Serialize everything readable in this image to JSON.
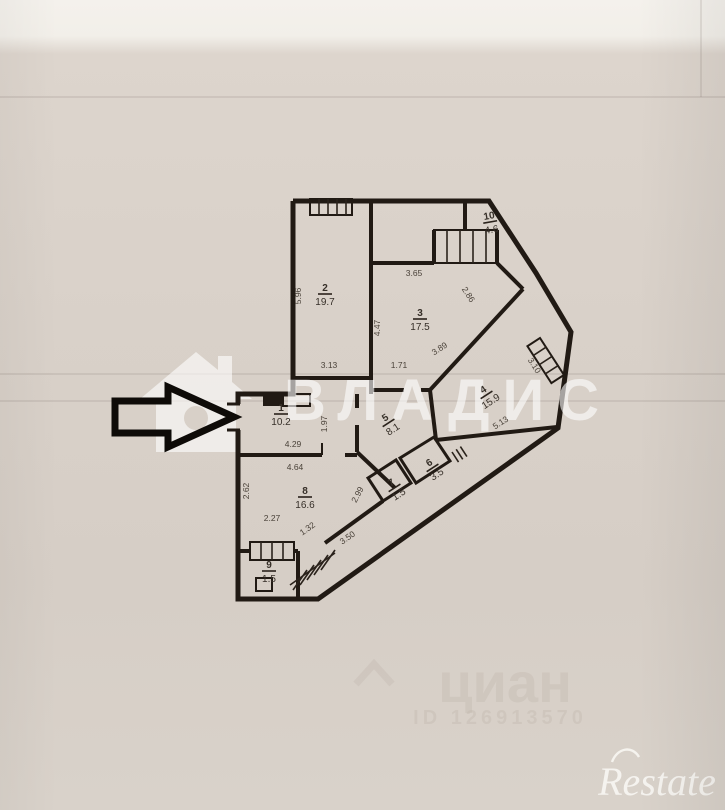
{
  "watermarks": {
    "vladis_text": "ВЛАДИС",
    "cian_text": "циан",
    "cian_id": "ID 126913570",
    "restate_text": "Restate"
  },
  "rooms": [
    {
      "number": "2",
      "area": "19.7"
    },
    {
      "number": "3",
      "area": "17.5"
    },
    {
      "number": "10",
      "area": "4.6"
    },
    {
      "number": "4",
      "area": "15.9"
    },
    {
      "number": "1",
      "area": "10.2"
    },
    {
      "number": "5",
      "area": "8.1"
    },
    {
      "number": "6",
      "area": "3.5"
    },
    {
      "number": "7",
      "area": "1.5"
    },
    {
      "number": "8",
      "area": "16.6"
    },
    {
      "number": "9",
      "area": "1.5"
    }
  ],
  "dimensions": [
    {
      "v": "5.96"
    },
    {
      "v": "3.13"
    },
    {
      "v": "4.47"
    },
    {
      "v": "3.65"
    },
    {
      "v": "2.86"
    },
    {
      "v": "1.71"
    },
    {
      "v": "3.89"
    },
    {
      "v": "3.10"
    },
    {
      "v": "5.13"
    },
    {
      "v": "1.97"
    },
    {
      "v": "4.29"
    },
    {
      "v": "4.64"
    },
    {
      "v": "2.62"
    },
    {
      "v": "2.27"
    },
    {
      "v": "2.99"
    },
    {
      "v": "3.50"
    },
    {
      "v": "1.32"
    }
  ],
  "colors": {
    "paper": "#d8d0c8",
    "wall": "#211a14",
    "label": "#362f28",
    "watermark_white": "#ffffff",
    "watermark_gray": "#c3b9af"
  }
}
